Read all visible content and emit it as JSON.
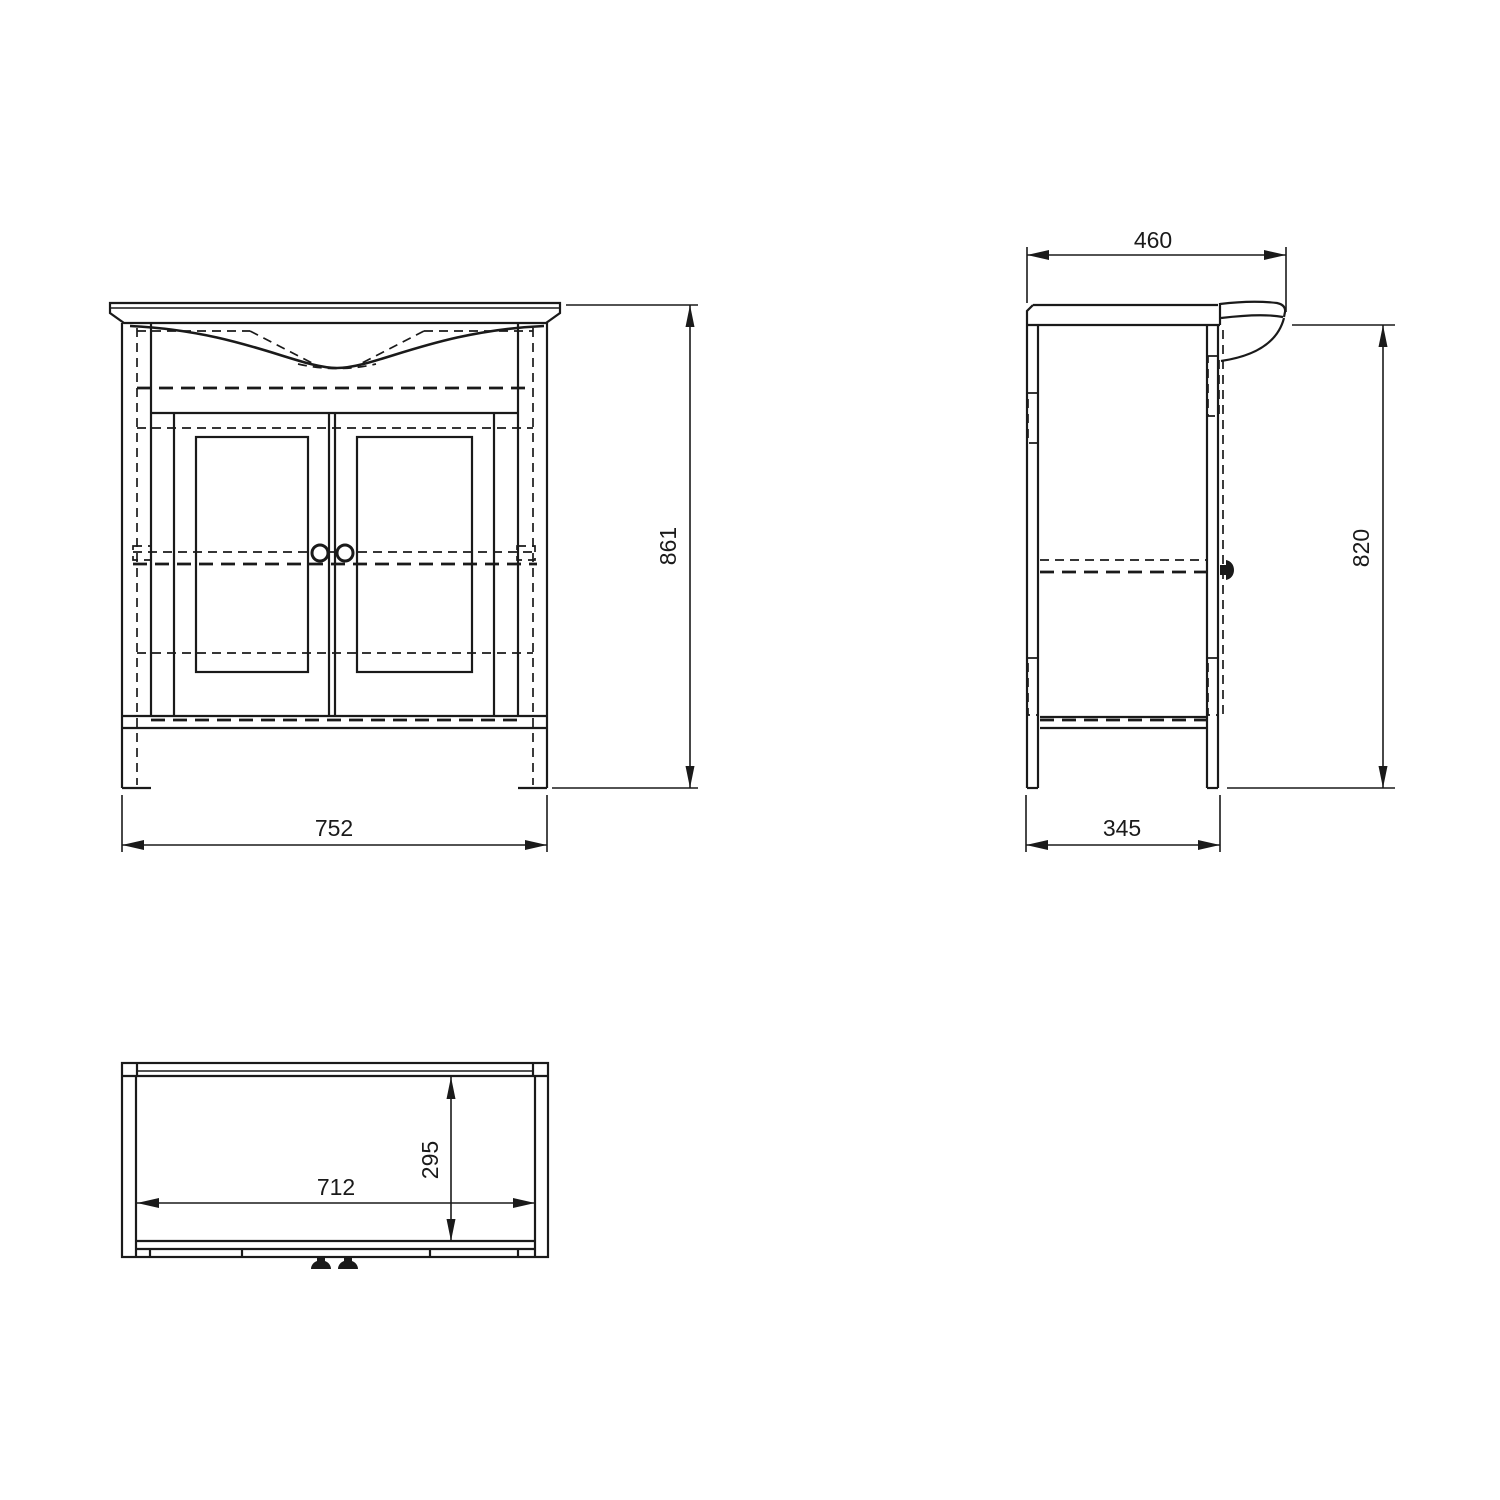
{
  "document": {
    "type": "technical-drawing",
    "subject": "vanity washbasin cabinet, three orthographic views"
  },
  "colors": {
    "background": "#ffffff",
    "line": "#1a1a1a"
  },
  "views": {
    "front": {
      "label": "front-view",
      "height_dim": "861",
      "width_dim": "752"
    },
    "side": {
      "label": "side-view",
      "top_depth_dim": "460",
      "height_dim": "820",
      "bottom_depth_dim": "345"
    },
    "plan": {
      "label": "plan-view",
      "inner_width_dim": "712",
      "inner_depth_dim": "295"
    }
  }
}
